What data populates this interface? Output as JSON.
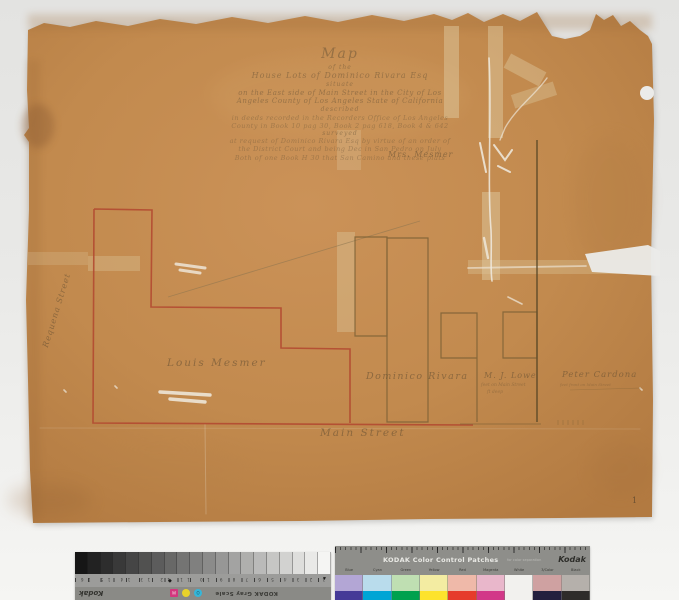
{
  "artifact": {
    "page_number": "1",
    "paper_color": "#c28a4e",
    "red_ink": "#b24a31",
    "sepia_ink": "#7d6136"
  },
  "title_block": {
    "lines": [
      "Map",
      "of the",
      "House Lots of Dominico Rivara Esq",
      "situate",
      "on the East side of Main Street in the City of Los",
      "Angeles County of Los Angeles State of California",
      "described",
      "in deeds recorded in the Recorders Office of Los Angeles",
      "County in Book 10 pag 30, Book 2 pag 618, Book 4 & 642",
      "surveyed",
      "at request of Dominico Rivara Esq by virtue of an order of",
      "the District Court and being Dec in San Pedro on July",
      "Both of one Book H 30 that San Camino and these plats"
    ]
  },
  "map_labels": {
    "mrs_mesmer": "Mrs. Mesmer",
    "louis_mesmer": "Louis Mesmer",
    "dominico_rivara": "Dominico Rivara",
    "mj_lowe": "M. J. Lowe",
    "mj_lowe_note1": "feet on Main Street",
    "mj_lowe_note2": "ft deep",
    "peter_cardona": "Peter Cardona",
    "peter_cardona_note": "feet front on Main Street",
    "main_street": "Main Street",
    "requena_street": "Requena Street"
  },
  "gray_scale": {
    "brand": "Kodak",
    "label": "KODAK Gray Scale",
    "tick_numbers": "1 2 3 4 5 6 7 8 9 10 11 12 13 14 15 16 17 18 19",
    "diamond": "◆",
    "arrow": "▼",
    "dot_letters": {
      "magenta": "M",
      "yellow": "",
      "cyan": "O"
    },
    "steps": 20,
    "start_color": "#161616",
    "end_color": "#f5f5f3"
  },
  "color_patches": {
    "title": "KODAK Color Control Patches",
    "subtitle": "for color separation",
    "brand": "Kodak",
    "columns": [
      {
        "label": "Blue",
        "light": "#b3a6d5",
        "dark": "#453a97"
      },
      {
        "label": "Cyan",
        "light": "#b9dcec",
        "dark": "#00a5d5"
      },
      {
        "label": "Green",
        "light": "#bfdfb2",
        "dark": "#00a14e"
      },
      {
        "label": "Yellow",
        "light": "#f3eca2",
        "dark": "#fde32d"
      },
      {
        "label": "Red",
        "light": "#efb9a9",
        "dark": "#e63b2b"
      },
      {
        "label": "Magenta",
        "light": "#e9b7cb",
        "dark": "#d23888"
      },
      {
        "label": "White",
        "light": "#f2f1ee",
        "dark": "#f2f1ee"
      },
      {
        "label": "3/Color",
        "light": "#cfa1a1",
        "dark": "#231f3e"
      },
      {
        "label": "Black",
        "light": "#b5b0ab",
        "dark": "#2e2c2a"
      }
    ]
  }
}
